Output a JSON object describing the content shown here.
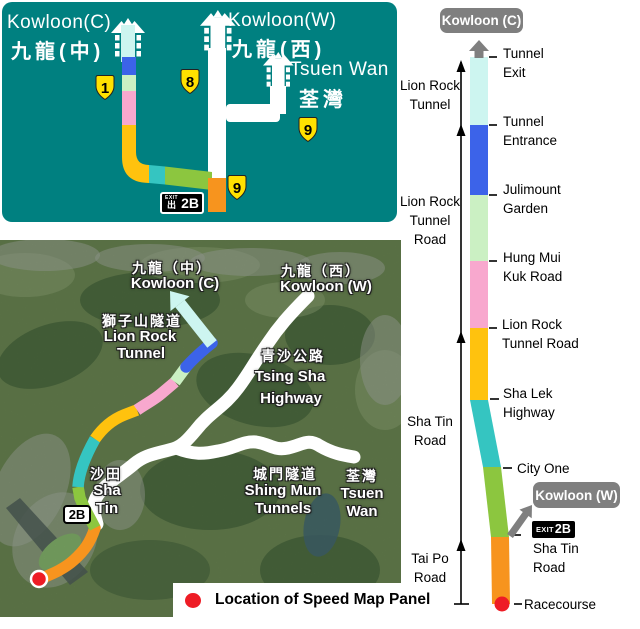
{
  "colors": {
    "panel_teal": "#008080",
    "segment_tunnel_cyan": "#CDF5F0",
    "segment_blue": "#3C63E9",
    "segment_light_green": "#CBF0C3",
    "segment_pink": "#F8A8CE",
    "segment_gold": "#FFC20E",
    "segment_teal": "#35C5C1",
    "segment_yellow_green": "#8CC63F",
    "segment_orange": "#F7941E",
    "road_white": "#FFFFFF",
    "badge_yellow": "#FFE100",
    "badge_gray": "#7F7F7F",
    "dot_red": "#EE1C25",
    "axis_black": "#000000"
  },
  "top_panel": {
    "kowloon_c_en": "Kowloon(C)",
    "kowloon_c_zh": "九龍(中)",
    "kowloon_w_en": "Kowloon(W)",
    "kowloon_w_zh": "九龍(西)",
    "tsuen_wan_en": "Tsuen Wan",
    "tsuen_wan_zh": "荃灣",
    "badge_1": "1",
    "badge_8": "8",
    "badge_9_tsuen_wan": "9",
    "badge_9_bottom": "9",
    "exit_badge": {
      "exit_text": "EXIT",
      "exit_char": "出",
      "code": "2B"
    }
  },
  "map": {
    "kowloon_c_zh": "九龍（中）",
    "kowloon_c_en": "Kowloon (C)",
    "lion_rock_zh": "獅子山隧道",
    "lion_rock_en_1": "Lion Rock",
    "lion_rock_en_2": "Tunnel",
    "kowloon_w_zh": "九龍（西）",
    "kowloon_w_en": "Kowloon (W)",
    "tsing_sha_zh": "青沙公路",
    "tsing_sha_en_1": "Tsing Sha",
    "tsing_sha_en_2": "Highway",
    "shing_mun_zh": "城門隧道",
    "shing_mun_en_1": "Shing Mun",
    "shing_mun_en_2": "Tunnels",
    "tsuen_wan_zh": "荃灣",
    "tsuen_wan_en_1": "Tsuen",
    "tsuen_wan_en_2": "Wan",
    "sha_tin_zh": "沙田",
    "sha_tin_en_1": "Sha",
    "sha_tin_en_2": "Tin",
    "exit_2b": "2B",
    "legend_label": "Location of Speed Map Panel"
  },
  "strip": {
    "dest_top": "Kowloon (C)",
    "dest_west": "Kowloon (W)",
    "exit": {
      "exit_text": "EXIT",
      "code": "2B"
    },
    "left_labels": {
      "lion_rock_tunnel": [
        "Lion Rock",
        "Tunnel"
      ],
      "lion_rock_tunnel_road": [
        "Lion Rock",
        "Tunnel",
        "Road"
      ],
      "sha_tin_road": [
        "Sha Tin",
        "Road"
      ],
      "tai_po_road": [
        "Tai Po",
        "Road"
      ]
    },
    "right_labels": {
      "tunnel_exit": [
        "Tunnel",
        "Exit"
      ],
      "tunnel_entrance": [
        "Tunnel",
        "Entrance"
      ],
      "julimount_garden": [
        "Julimount",
        "Garden"
      ],
      "hung_mui_kuk_road": [
        "Hung Mui",
        "Kuk Road"
      ],
      "lion_rock_tunnel_road": [
        "Lion Rock",
        "Tunnel Road"
      ],
      "sha_lek_highway": [
        "Sha Lek",
        "Highway"
      ],
      "city_one": "City One",
      "sha_tin_road": [
        "Sha Tin",
        "Road"
      ],
      "racecourse": "Racecourse"
    }
  }
}
